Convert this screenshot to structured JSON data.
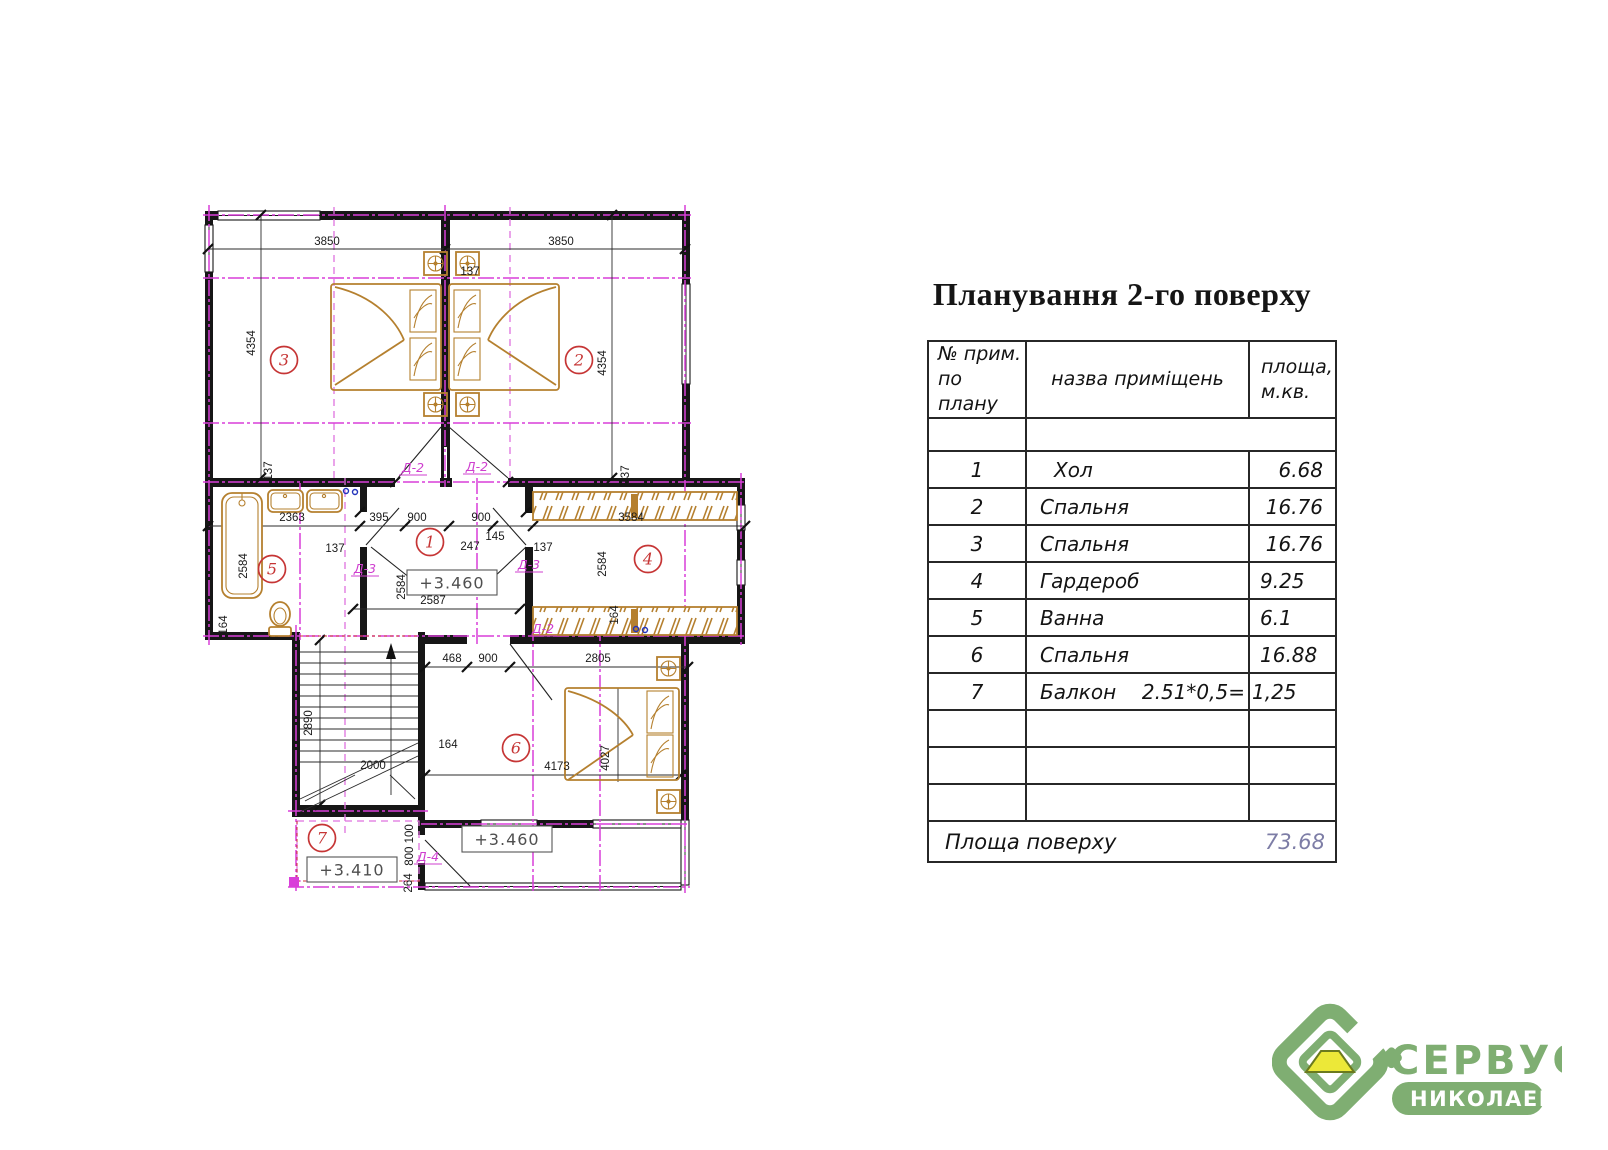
{
  "title": "Планування 2-го поверху",
  "table": {
    "headers": {
      "col1_line1": "№ прим.",
      "col1_line2": "по плану",
      "col2": "назва приміщень",
      "col3_line1": "площа,",
      "col3_line2": "м.кв."
    },
    "rows": [
      {
        "num": "1",
        "name": "Хол",
        "area": "6.68"
      },
      {
        "num": "2",
        "name": "Спальня",
        "area": "16.76"
      },
      {
        "num": "3",
        "name": "Спальня",
        "area": "16.76"
      },
      {
        "num": "4",
        "name": "Гардероб",
        "area": "9.25"
      },
      {
        "num": "5",
        "name": "Ванна",
        "area": "6.1"
      },
      {
        "num": "6",
        "name": "Спальня",
        "area": "16.88"
      },
      {
        "num": "7",
        "name": "Балкон",
        "formula": "2.51*0,5=",
        "area": "1,25"
      }
    ],
    "footer": {
      "label": "Площа поверху",
      "value": "73.68"
    }
  },
  "plan": {
    "room_numbers": [
      {
        "n": "3",
        "x": 99,
        "y": 165
      },
      {
        "n": "2",
        "x": 394,
        "y": 165
      },
      {
        "n": "5",
        "x": 87,
        "y": 374
      },
      {
        "n": "1",
        "x": 245,
        "y": 347
      },
      {
        "n": "4",
        "x": 463,
        "y": 364
      },
      {
        "n": "6",
        "x": 331,
        "y": 553
      },
      {
        "n": "7",
        "x": 137,
        "y": 643
      }
    ],
    "dims": [
      {
        "t": "3850",
        "x": 142,
        "y": 50
      },
      {
        "t": "3850",
        "x": 376,
        "y": 50
      },
      {
        "t": "137",
        "x": 285,
        "y": 80
      },
      {
        "t": "4354",
        "x": 70,
        "y": 148,
        "r": -90
      },
      {
        "t": "4354",
        "x": 421,
        "y": 168,
        "r": -90
      },
      {
        "t": "137",
        "x": 87,
        "y": 276,
        "r": -90
      },
      {
        "t": "137",
        "x": 444,
        "y": 280,
        "r": -90
      },
      {
        "t": "2363",
        "x": 107,
        "y": 326
      },
      {
        "t": "395",
        "x": 194,
        "y": 326
      },
      {
        "t": "900",
        "x": 232,
        "y": 326
      },
      {
        "t": "900",
        "x": 296,
        "y": 326
      },
      {
        "t": "3584",
        "x": 446,
        "y": 326
      },
      {
        "t": "137",
        "x": 150,
        "y": 357
      },
      {
        "t": "247",
        "x": 285,
        "y": 355
      },
      {
        "t": "145",
        "x": 310,
        "y": 345
      },
      {
        "t": "137",
        "x": 358,
        "y": 356
      },
      {
        "t": "2584",
        "x": 62,
        "y": 371,
        "r": -90
      },
      {
        "t": "2584",
        "x": 220,
        "y": 392,
        "r": -90,
        "s": 9
      },
      {
        "t": "2584",
        "x": 421,
        "y": 369,
        "r": -90
      },
      {
        "t": "2587",
        "x": 248,
        "y": 409
      },
      {
        "t": "164",
        "x": 42,
        "y": 430,
        "r": -90
      },
      {
        "t": "164",
        "x": 433,
        "y": 420,
        "r": -90,
        "s": 9
      },
      {
        "t": "468",
        "x": 267,
        "y": 467
      },
      {
        "t": "900",
        "x": 303,
        "y": 467
      },
      {
        "t": "2805",
        "x": 413,
        "y": 467
      },
      {
        "t": "2890",
        "x": 127,
        "y": 528,
        "r": -90
      },
      {
        "t": "2000",
        "x": 188,
        "y": 574
      },
      {
        "t": "164",
        "x": 263,
        "y": 553
      },
      {
        "t": "4173",
        "x": 372,
        "y": 575
      },
      {
        "t": "4027",
        "x": 424,
        "y": 563,
        "r": -90
      },
      {
        "t": "800 100",
        "x": 228,
        "y": 650,
        "r": -90,
        "s": 9
      },
      {
        "t": "264",
        "x": 227,
        "y": 688,
        "r": -90,
        "s": 8
      }
    ],
    "door_labels": [
      {
        "t": "Д-2",
        "x": 228,
        "y": 277
      },
      {
        "t": "Д-2",
        "x": 292,
        "y": 276
      },
      {
        "t": "Д-3",
        "x": 180,
        "y": 378
      },
      {
        "t": "Д-3",
        "x": 344,
        "y": 374
      },
      {
        "t": "Д-2",
        "x": 358,
        "y": 438
      },
      {
        "t": "Д-4",
        "x": 243,
        "y": 666
      }
    ],
    "levels": [
      {
        "t": "+3.460",
        "bx": 222,
        "by": 375,
        "bw": 90,
        "bh": 25
      },
      {
        "t": "+3.460",
        "bx": 277,
        "by": 631,
        "bw": 90,
        "bh": 26
      },
      {
        "t": "+3.410",
        "bx": 122,
        "by": 662,
        "bw": 90,
        "bh": 25
      }
    ]
  },
  "logo": {
    "line1": "СЕРВУС",
    "line2": "НИКОЛАЕВ"
  },
  "colors": {
    "axis_magenta": "#d93fd9",
    "furniture": "#b5802f",
    "marker_red": "#c63535",
    "logo_green": "#7fae72",
    "logo_yellow": "#ece838",
    "total_value": "#7d7da6"
  }
}
